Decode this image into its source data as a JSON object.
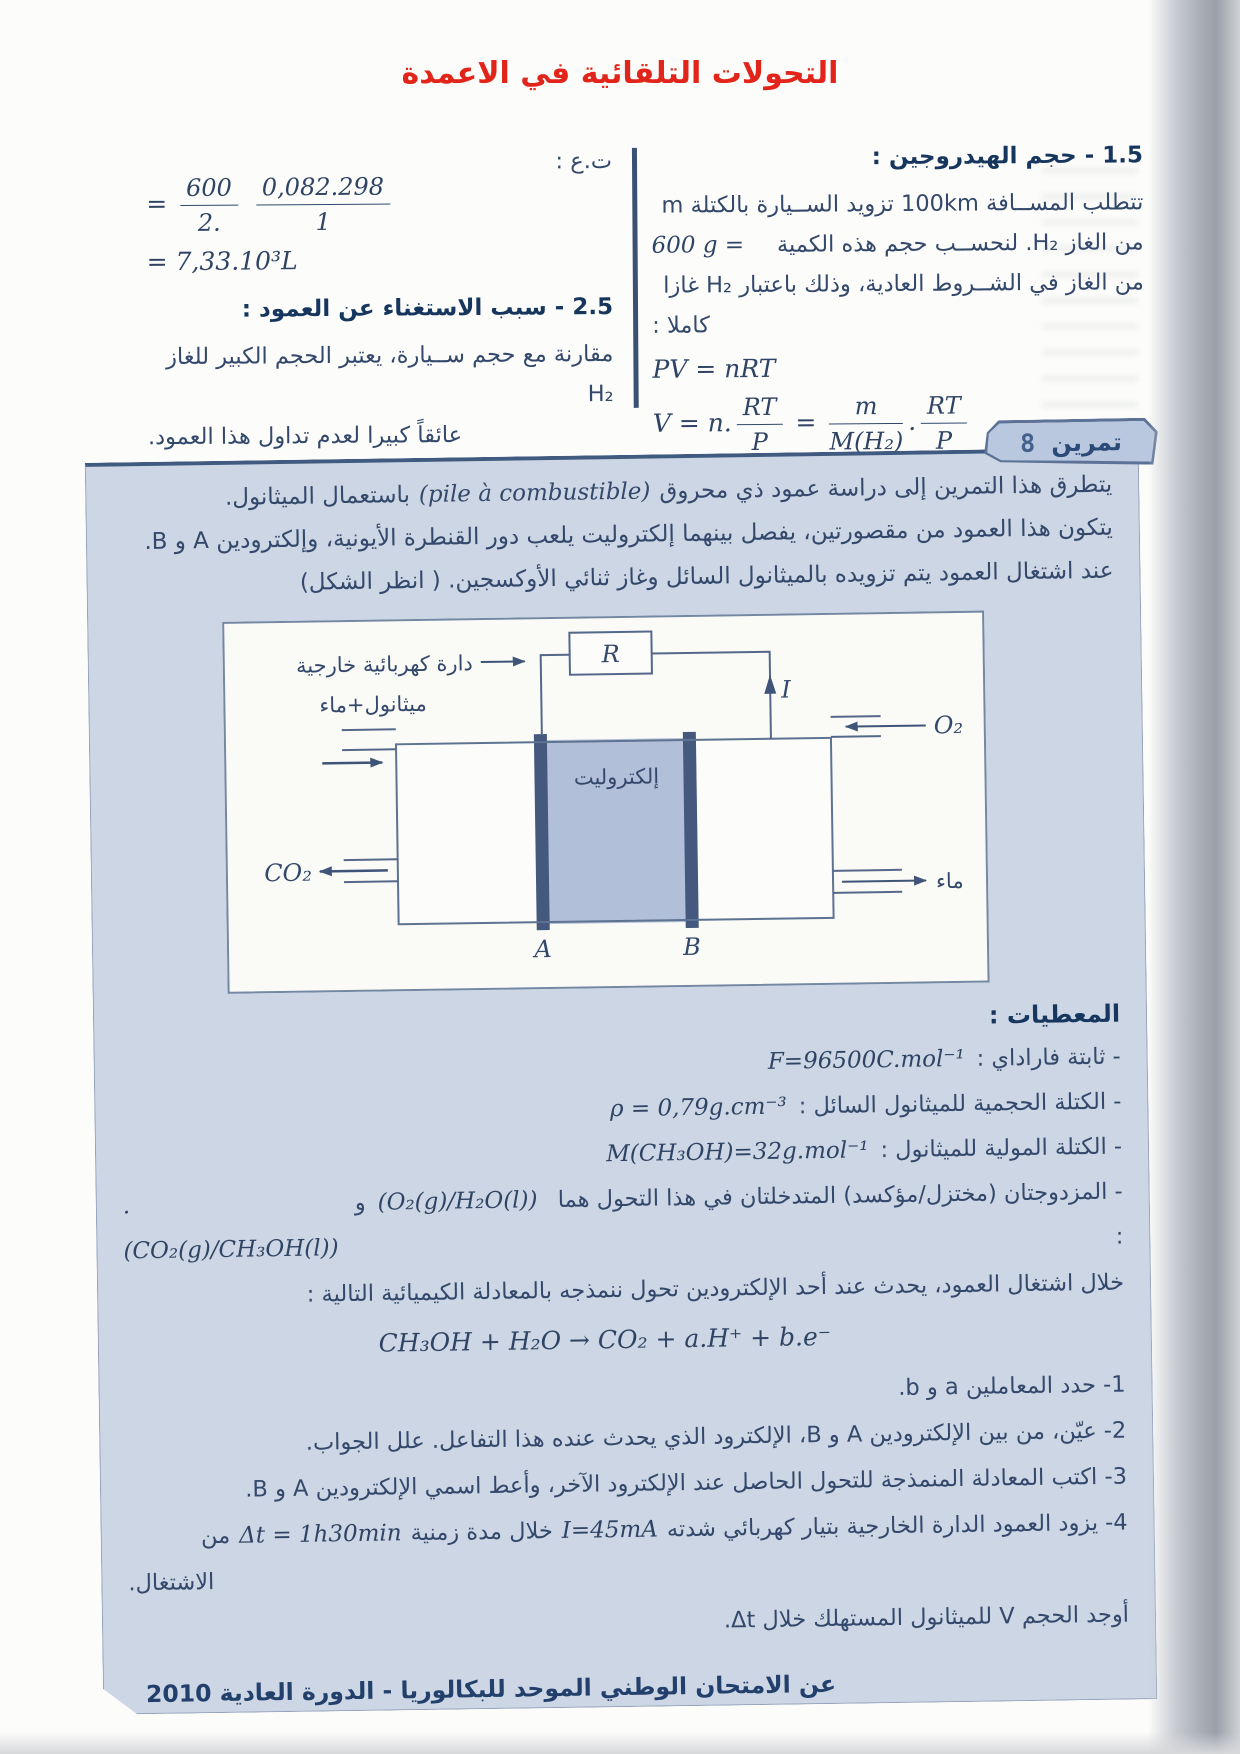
{
  "page": {
    "title": "التحولات التلقائية في الاعمدة"
  },
  "solution": {
    "sec1": {
      "heading": "1.5 - حجم الهيدروجين :",
      "line1": "تتطلب المســافة 100km تزويد الســيارة بالكتلة m",
      "line2_text": "من الغاز H₂. لنحســب حجم هذه الكمية",
      "line2_value": "600 g =",
      "line3": "من الغاز في الشــروط العادية، وذلك باعتبار H₂ غازا",
      "line4": "كاملا :",
      "eq_state": "PV = nRT",
      "eq_volume": {
        "lhs": "V = n.",
        "f1n": "RT",
        "f1d": "P",
        "eq": "=",
        "f2n": "m",
        "f2d": "M(H₂)",
        "dot": ".",
        "f3n": "RT",
        "f3d": "P"
      }
    },
    "numeric_application": {
      "label": "ت.ع :",
      "eq": {
        "lhs": "=",
        "f1n": "600",
        "f1d": "2.",
        "f2n": "0,082.298",
        "f2d": "1"
      },
      "result": "= 7,33.10³L"
    },
    "sec2": {
      "heading": "2.5 - سبب الاستغناء عن العمود :",
      "line1": "مقارنة مع حجم ســيارة، يعتبر الحجم الكبير للغاز H₂",
      "line2": "عائقاً كبيرا لعدم تداول هذا العمود."
    }
  },
  "exercise": {
    "badge": {
      "label": "تمرين",
      "number": "8"
    },
    "intro": {
      "l1a": "يتطرق هذا التمرين إلى دراسة عمود ذي محروق",
      "l1b": "(pile à combustible)",
      "l1c": "باستعمال الميثانول.",
      "l2": "يتكون هذا العمود من مقصورتين، يفصل بينهما إلكتروليت يلعب دور القنطرة الأيونية، وإلكترودين A و B.",
      "l3": "عند اشتغال العمود يتم تزويده بالميثانول السائل وغاز ثنائي الأوكسجين. ( انظر الشكل)"
    },
    "figure": {
      "resistor": "R",
      "current": "I",
      "external_circuit": "دارة كهربائية خارجية",
      "methanol_water": "ميثانول+ماء",
      "oxygen": "O₂",
      "electrolyte": "إلكتروليت",
      "co2": "CO₂",
      "water": "ماء",
      "electrode_a": "A",
      "electrode_b": "B"
    },
    "data": {
      "heading": "المعطيات :",
      "faraday_label": "- ثابتة فاراداي :",
      "faraday_value": "F=96500C.mol⁻¹",
      "density_label": "- الكتلة الحجمية للميثانول السائل :",
      "density_value": "ρ = 0,79g.cm⁻³",
      "molar_label": "- الكتلة المولية للميثانول :",
      "molar_value": "M(CH₃OH)=32g.mol⁻¹",
      "couples_label": "- المزدوجتان (مختزل/مؤكسد) المتدخلتان في هذا التحول هما :",
      "couple1": "(O₂(g)/H₂O(l))",
      "couples_and": "و",
      "couple2": ".(CO₂(g)/CH₃OH(l))",
      "transform_line": "خلال اشتغال العمود، يحدث عند أحد الإلكترودين تحول ننمذجه بالمعادلة الكيميائية التالية :",
      "equation": "CH₃OH + H₂O → CO₂ + a.H⁺ + b.e⁻"
    },
    "questions": {
      "q1": "1- حدد المعاملين a و b.",
      "q2": "2- عيّن، من بين الإلكترودين A و B، الإلكترود الذي يحدث عنده هذا التفاعل. علل الجواب.",
      "q3": "3- اكتب المعادلة المنمذجة للتحول الحاصل عند الإلكترود الآخر، وأعط اسمي الإلكترودين A و B.",
      "q4_text": "4- يزود العمود الدارة الخارجية بتيار كهربائي شدته",
      "q4_current": "I=45mA",
      "q4_mid": "خلال مدة زمنية",
      "q4_duration": "Δt = 1h30min",
      "q4_end": "من",
      "q4_cont": "الاشتغال.",
      "final": "أوجد الحجم V للميثانول المستهلك خلال Δt."
    },
    "source": {
      "line1": "عن الامتحان الوطني الموحد للبكالوريا - الدورة العادية 2010",
      "line2": "شعبة العلوم التجريبية - مسلك العلوم الفيزيائية"
    }
  },
  "colors": {
    "title_red": "#e2251b",
    "panel_bg": "#ccd6e4",
    "ink": "#33486b",
    "heading_ink": "#16365e",
    "line_dark": "#405a80",
    "electrolyte_fill": "#b2bfd8",
    "electrode_fill": "#45597e"
  }
}
